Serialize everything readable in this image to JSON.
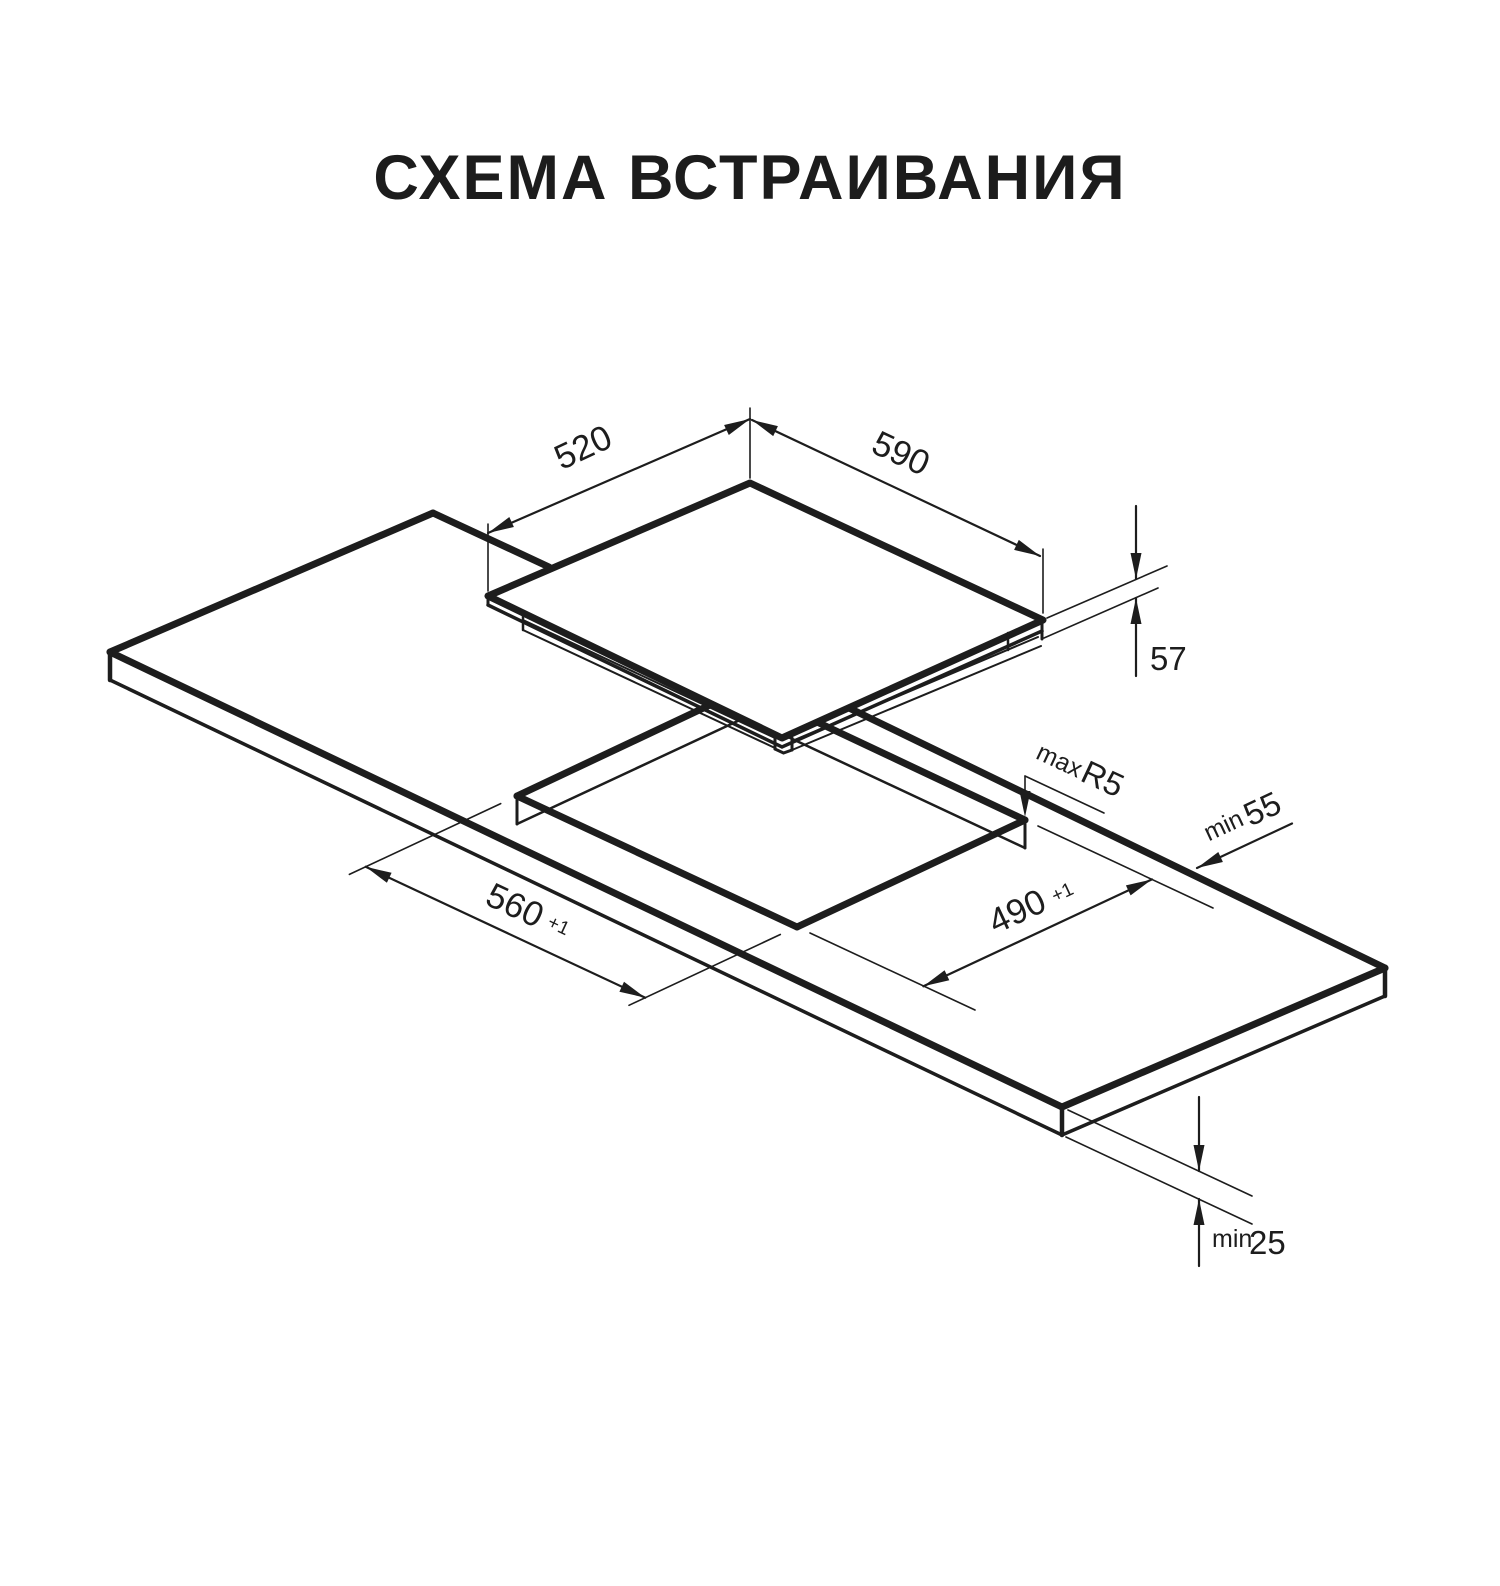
{
  "title": "СХЕМА ВСТРАИВАНИЯ",
  "colors": {
    "line": "#1d1d1d",
    "background": "#ffffff"
  },
  "diagram": {
    "kind": "isometric built-in hob installation drawing",
    "parts": [
      "hob panel with tub",
      "worktop with rectangular cutout"
    ]
  },
  "labels": {
    "dim_520": "520",
    "dim_590": "590",
    "dim_57": "57",
    "max_r5_prefix": "max",
    "max_r5_value": "R5",
    "min_55_prefix": "min",
    "min_55_value": "55",
    "dim_490": "490",
    "dim_490_tol": "+1",
    "dim_560": "560",
    "dim_560_tol": "+1",
    "min_25_prefix": "min",
    "min_25_value": "25"
  }
}
